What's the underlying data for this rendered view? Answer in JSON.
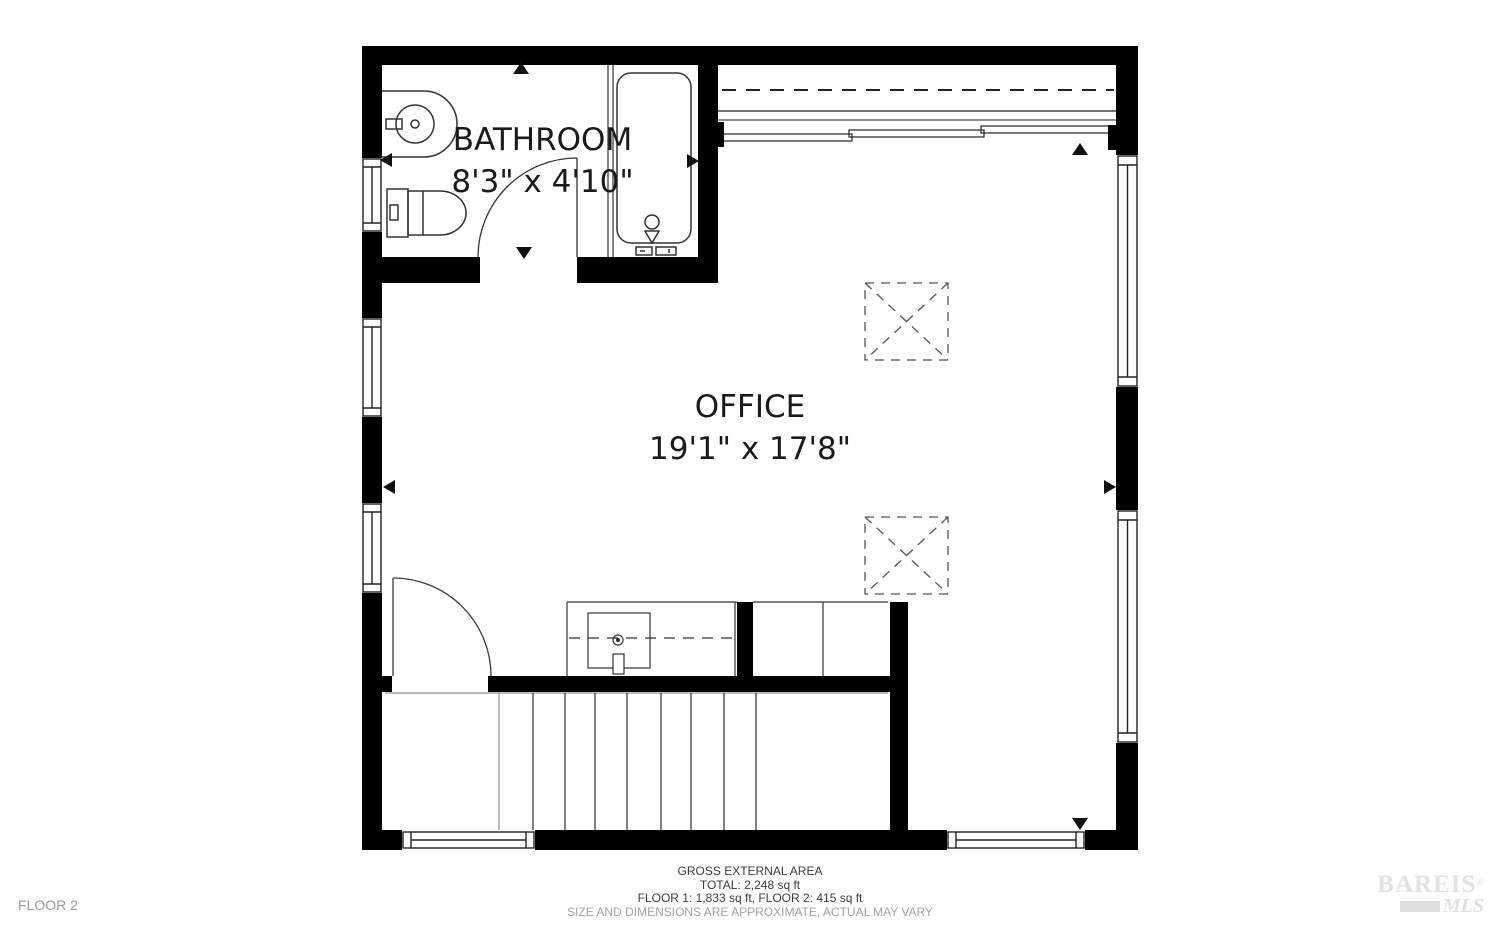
{
  "floor_plan": {
    "floor_label": "FLOOR 2",
    "rooms": [
      {
        "name": "BATHROOM",
        "dimensions": "8'3\" x 4'10\"",
        "fixtures": [
          "sink",
          "toilet",
          "bathtub",
          "door"
        ]
      },
      {
        "name": "OFFICE",
        "dimensions": "19'1\" x 17'8\"",
        "features": [
          "sliding-door",
          "skylight",
          "skylight",
          "stairs",
          "closet",
          "entry-door"
        ]
      }
    ],
    "wall_color": "#000000",
    "line_color": "#333333",
    "dashed_color": "#555555"
  },
  "footer": {
    "title": "GROSS EXTERNAL AREA",
    "total": "TOTAL: 2,248 sq ft",
    "floors": "FLOOR 1: 1,833 sq ft, FLOOR 2: 415 sq ft",
    "disclaimer": "SIZE AND DIMENSIONS ARE APPROXIMATE, ACTUAL MAY VARY"
  },
  "watermark": {
    "brand": "BAREIS",
    "registered": "®",
    "sub": "MLS"
  }
}
